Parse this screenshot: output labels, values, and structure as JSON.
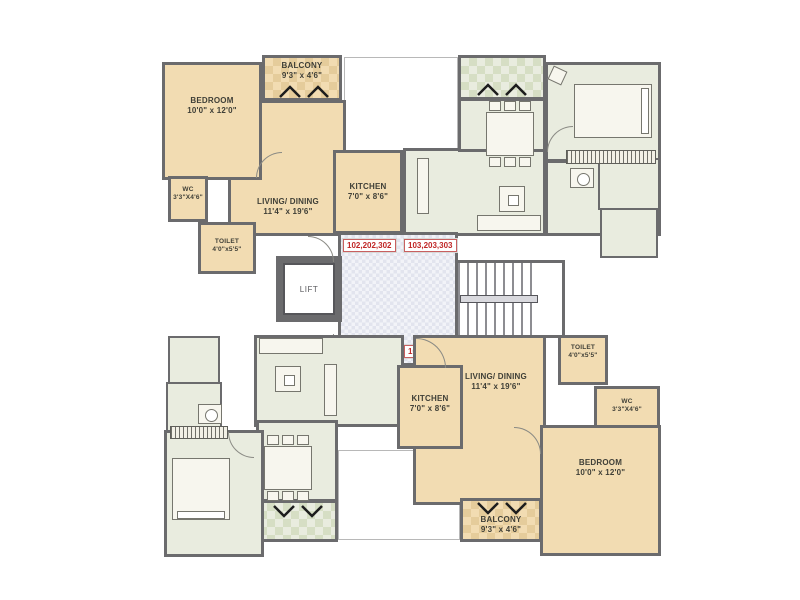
{
  "plan_title": "four-unit-apartment-floor-plan",
  "core": {
    "lift": "LIFT"
  },
  "units": {
    "u101": {
      "label": "101,201,301"
    },
    "u102": {
      "label": "102,202,302",
      "rooms": {
        "bedroom": {
          "name": "BEDROOM",
          "dims": "10'0\" x 12'0\""
        },
        "balcony": {
          "name": "BALCONY",
          "dims": "9'3\" x 4'6\""
        },
        "living": {
          "name": "LIVING/ DINING",
          "dims": "11'4\" x 19'6\""
        },
        "kitchen": {
          "name": "KITCHEN",
          "dims": "7'0\" x 8'6\""
        },
        "wc": {
          "name": "WC",
          "dims": "3'3\"X4'6\""
        },
        "toilet": {
          "name": "TOILET",
          "dims": "4'0\"x5'5\""
        }
      }
    },
    "u103": {
      "label": "103,203,303"
    },
    "u104": {
      "label": "104,204,304",
      "rooms": {
        "bedroom": {
          "name": "BEDROOM",
          "dims": "10'0\" x 12'0\""
        },
        "balcony": {
          "name": "BALCONY",
          "dims": "9'3\" x 4'6\""
        },
        "living": {
          "name": "LIVING/ DINING",
          "dims": "11'4\" x 19'6\""
        },
        "kitchen": {
          "name": "KITCHEN",
          "dims": "7'0\" x 8'6\""
        },
        "wc": {
          "name": "WC",
          "dims": "3'3\"X4'6\""
        },
        "toilet": {
          "name": "TOILET",
          "dims": "4'0\"x5'5\""
        }
      }
    }
  },
  "colors": {
    "wall": "#6b6b6d",
    "unit_fill_tan": "#f2dcb2",
    "unit_fill_green": "#e9ecdf",
    "lobby_fill": "#f2f3f8",
    "unit_label_red": "#c02626",
    "background": "#ffffff"
  }
}
